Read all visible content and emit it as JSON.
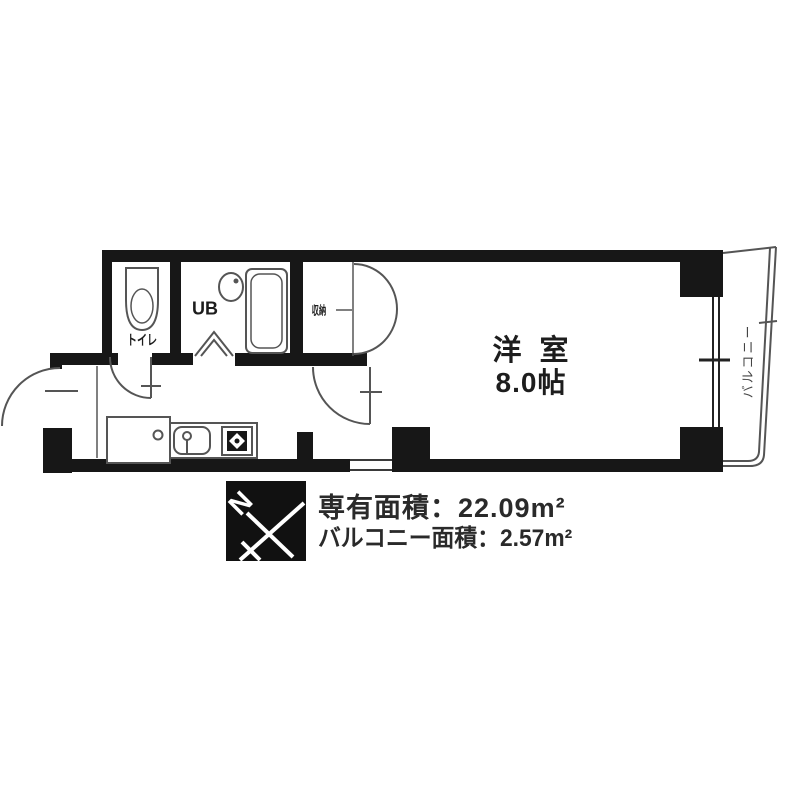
{
  "floor_plan": {
    "rooms": {
      "main_room": {
        "name": "洋 室",
        "size": "8.0帖"
      },
      "toilet": {
        "label": "トイレ"
      },
      "unit_bath": {
        "label": "UB"
      },
      "storage": {
        "label": "収納"
      },
      "balcony": {
        "label": "バルコニー"
      }
    },
    "compass": {
      "north_label": "N"
    },
    "areas": {
      "exclusive": {
        "label": "専有面積",
        "value": "22.09m²",
        "display": "専有面積：22.09m²"
      },
      "balcony": {
        "label": "バルコニー面積",
        "value": "2.57m²",
        "display": "バルコニー面積：2.57m²"
      }
    },
    "colors": {
      "wall": "#171717",
      "thin_line": "#555555",
      "text": "#2a2a2a"
    }
  }
}
